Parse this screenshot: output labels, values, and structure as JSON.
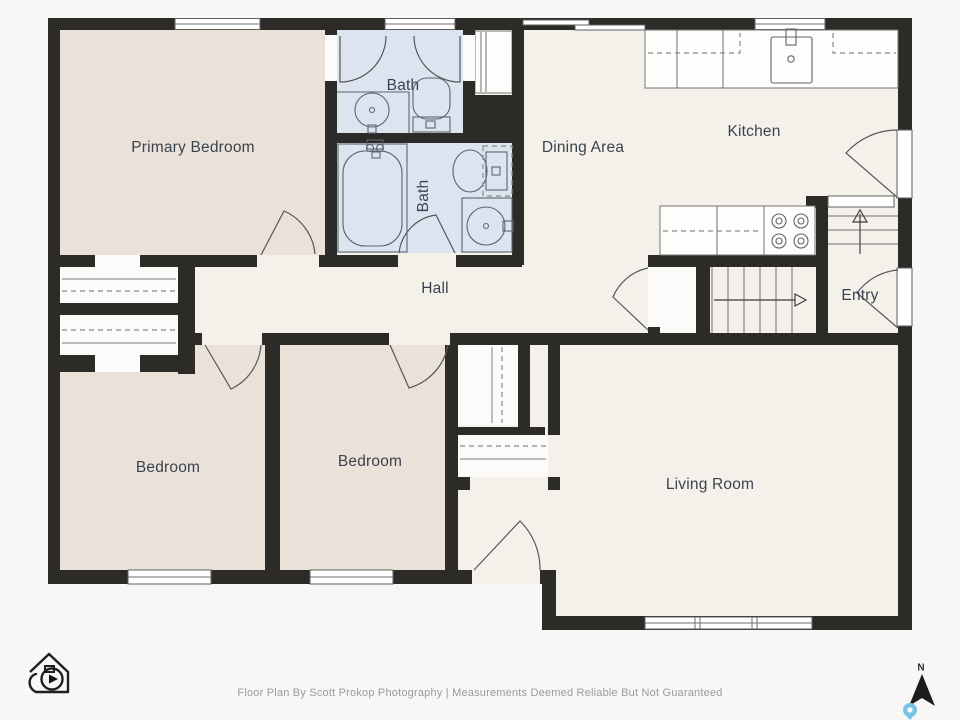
{
  "rooms": {
    "primary_bedroom": "Primary Bedroom",
    "bath_top": "Bath",
    "bath_bottom": "Bath",
    "dining": "Dining Area",
    "kitchen": "Kitchen",
    "hall": "Hall",
    "entry": "Entry",
    "bedroom_left": "Bedroom",
    "bedroom_middle": "Bedroom",
    "living": "Living Room"
  },
  "compass": {
    "north_label": "N"
  },
  "footer": {
    "credit_line": "Floor Plan By Scott Prokop Photography | Measurements Deemed Reliable But Not Guaranteed"
  },
  "branding": {
    "logo": "house-camera-photography-logo"
  },
  "icons": {
    "compass_needle": "north-arrow-icon",
    "map_pin": "map-pin-icon",
    "stairs_up": "stairs-up-arrow",
    "stairs_down": "stairs-down-arrow"
  },
  "colors": {
    "background": "#f7f7f6",
    "wall": "#2d2b28",
    "floor": "#f4f1ea",
    "bedroom_floor": "#eae2d8",
    "bathroom_floor": "#dce4f0",
    "label_text": "#3c4350",
    "footer_text": "#9b9b9b",
    "compass": "#1c1c1c",
    "map_pin": "#79c3e6"
  }
}
